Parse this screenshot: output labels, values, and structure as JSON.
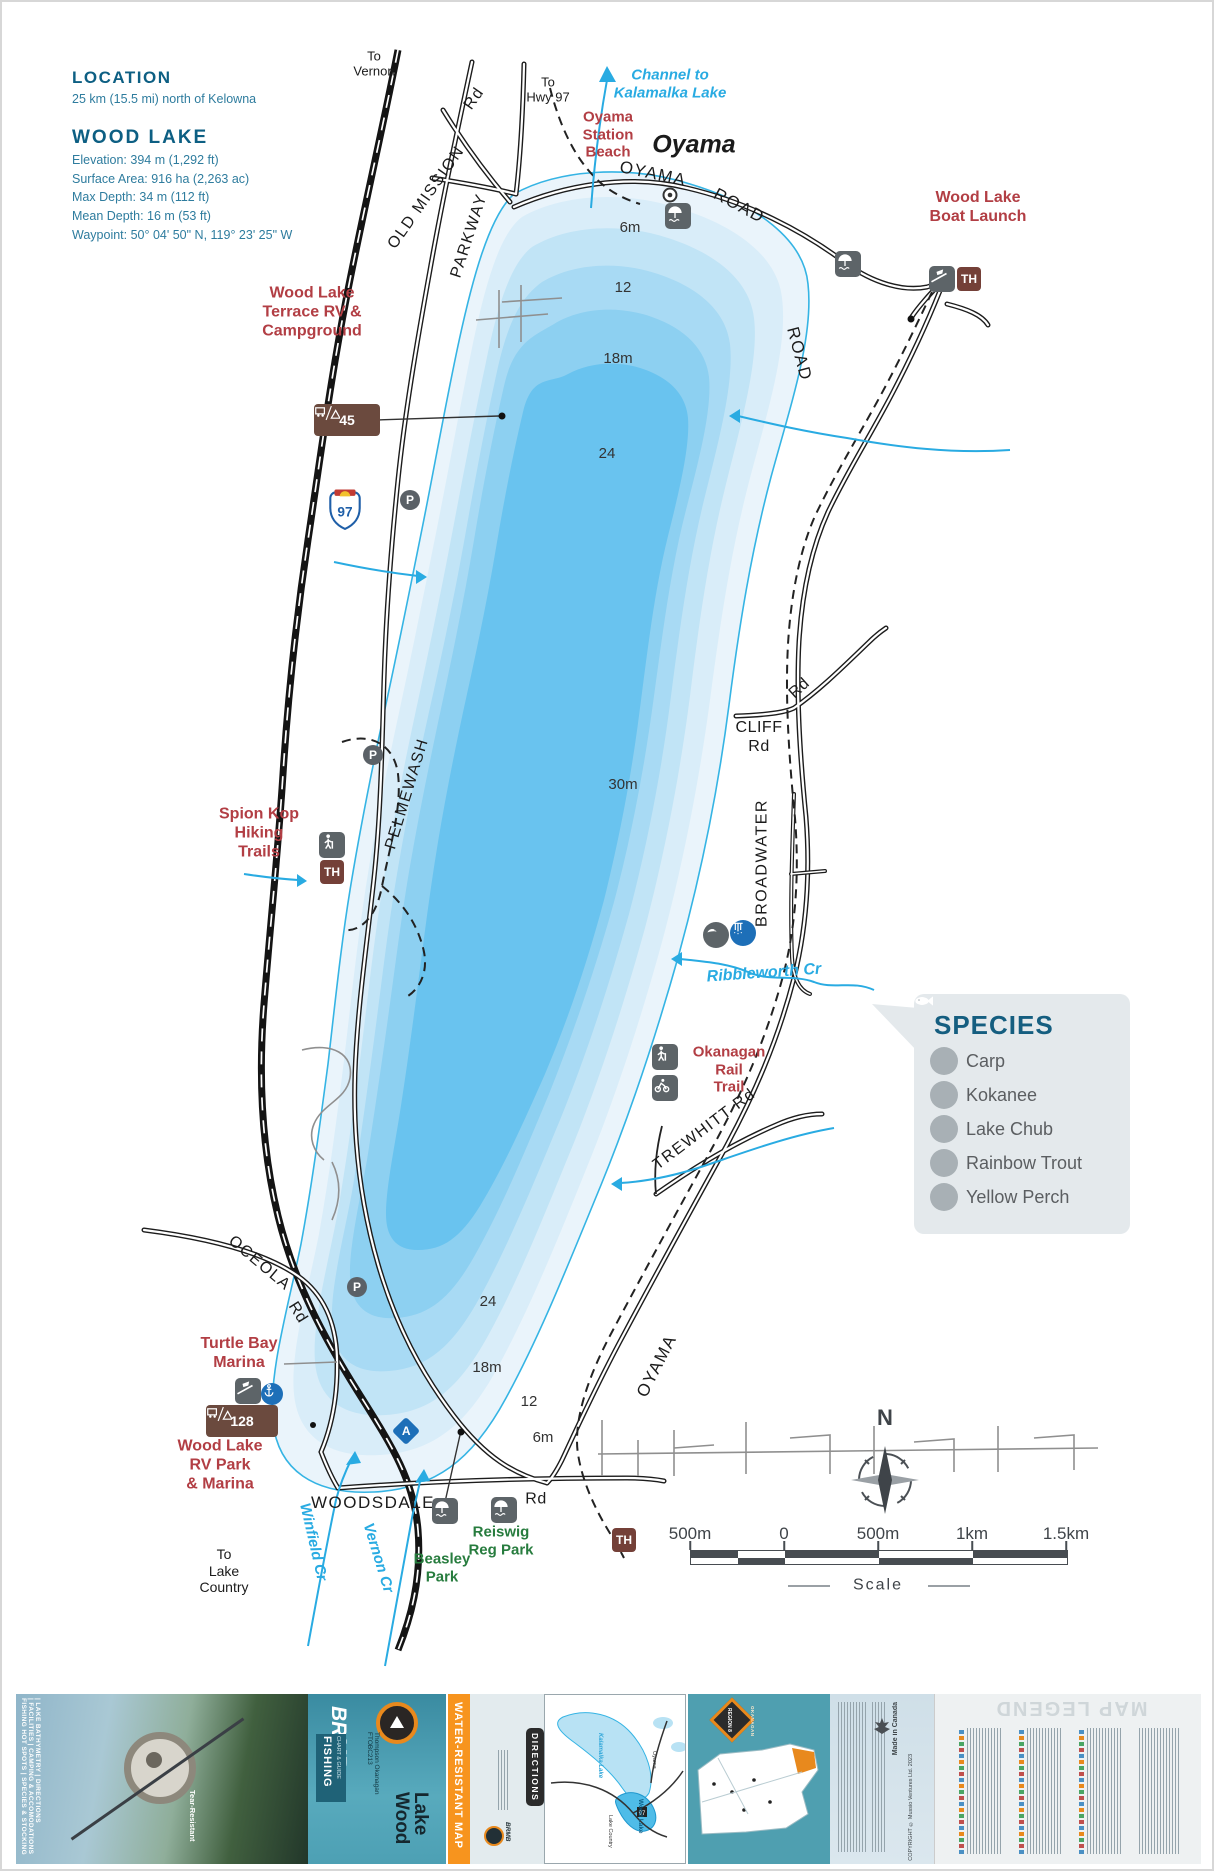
{
  "info": {
    "location_heading": "LOCATION",
    "location_text": "25 km (15.5 mi) north of Kelowna",
    "lake_heading": "WOOD LAKE",
    "stats": [
      "Elevation: 394 m (1,292 ft)",
      "Surface Area: 916 ha (2,263 ac)",
      "Max Depth: 34 m (112 ft)",
      "Mean Depth: 16 m (53 ft)",
      "Waypoint: 50° 04' 50\" N, 119° 23' 25\" W"
    ]
  },
  "labels": {
    "to_vernon": "To\nVernon",
    "to_hwy97": "To\nHwy 97",
    "channel": "Channel to\nKalamalka Lake",
    "oyama_station_beach": "Oyama\nStation\nBeach",
    "oyama_town": "Oyama",
    "boat_launch": "Wood Lake\nBoat Launch",
    "terrace_rv": "Wood Lake\nTerrace RV &\nCampground",
    "spion_kop": "Spion Kop\nHiking\nTrails",
    "okanagan_rail_trail": "Okanagan\nRail\nTrail",
    "turtle_bay": "Turtle Bay\nMarina",
    "rv_park": "Wood Lake\nRV Park\n& Marina",
    "to_lake_country": "To\nLake\nCountry",
    "beasley": "Beasley\nPark",
    "reiswig": "Reiswig\nReg Park",
    "ribbleworth": "Ribbleworth Cr",
    "winfield": "Winfield Cr",
    "vernon_cr": "Vernon Cr"
  },
  "roads": {
    "rd": "Rd",
    "old_mission": "OLD MISSION",
    "parkway": "PARKWAY",
    "oyama": "OYAMA",
    "road": "ROAD",
    "pelmewash": "PELMEWASH",
    "cliff": "CLIFF\nRd",
    "broadwater": "BROADWATER",
    "trewhitt": "TREWHITT  Rd",
    "oceola": "OCEOLA",
    "woodsdale": "WOODSDALE"
  },
  "depths": {
    "d6n": "6m",
    "d12n": "12",
    "d18n": "18m",
    "d24n": "24",
    "d30": "30m",
    "d24s": "24",
    "d18s": "18m",
    "d12s": "12",
    "d6s": "6m"
  },
  "signs": {
    "th": "TH",
    "camp_terrace": "45",
    "camp_rv": "128",
    "parking": "P",
    "anchorage": "A",
    "hwy": "97"
  },
  "species": {
    "title": "SPECIES",
    "items": [
      "Carp",
      "Kokanee",
      "Lake Chub",
      "Rainbow Trout",
      "Yellow Perch"
    ]
  },
  "compass": {
    "north": "N"
  },
  "scale": {
    "ticks": [
      "500m",
      "0",
      "500m",
      "1km",
      "1.5km"
    ],
    "caption": "Scale"
  },
  "footer": {
    "tagline": "FISHING HOT SPOTS | SPECIES & STOCKING | FACILITIES | CAMPING & ACCOMODATIONS | LAKE BATHYMETRY | DIRECTIONS",
    "tear": "Tear-Resistant",
    "brand": "BRMB",
    "fishing": "FISHING",
    "chart_guide": "CHART & GUIDE",
    "series": "Thompson Okanagan FTOBC213",
    "map_title": "Wood\nLake",
    "water_resistant": "WATER-RESISTANT MAP",
    "directions": "DIRECTIONS",
    "region_badge": "REGION 8",
    "region_name": "OKANAGAN",
    "made_in": "Made in Canada",
    "copyright": "COPYRIGHT © Mussio Ventures Ltd. 2023",
    "legend_title": "MAP LEGEND",
    "inset": {
      "kalamalka": "Kalamalka Lake",
      "wood_lake": "Wood Lake",
      "oyama": "Oyama",
      "lake_country": "Lake Country",
      "hwy": "97"
    }
  }
}
